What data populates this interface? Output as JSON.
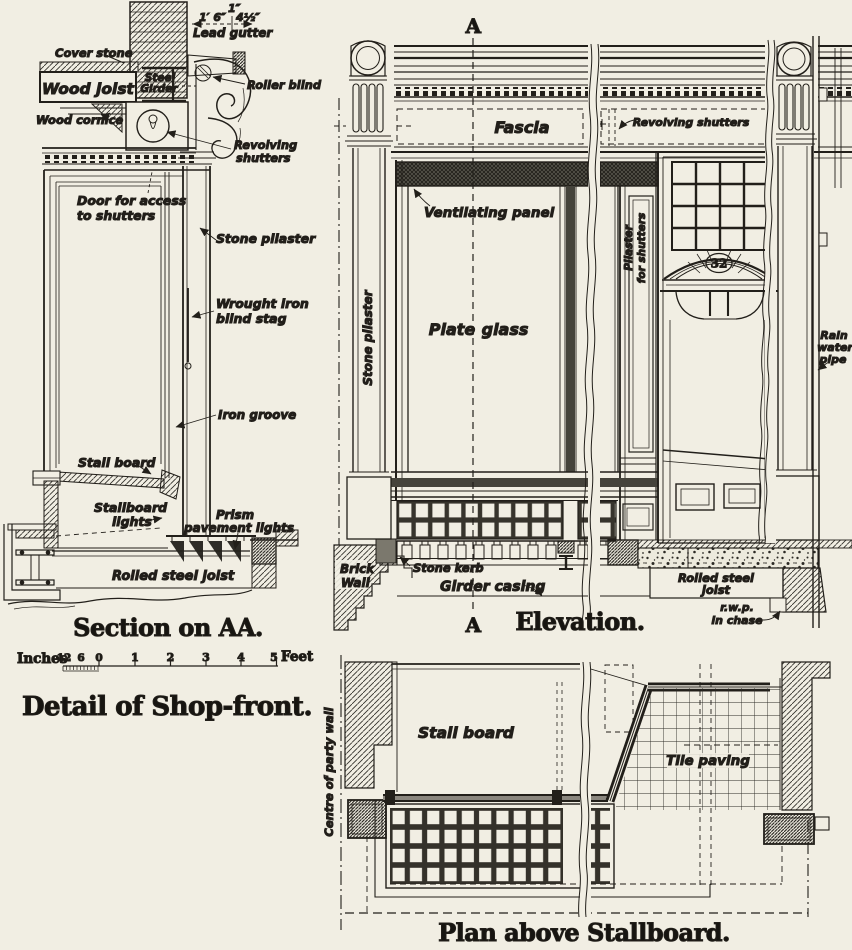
{
  "section": {
    "title": "Section on AA.",
    "dims": {
      "top": "1″",
      "gutter_width": "1′ 6″",
      "right": "4½″"
    },
    "labels": {
      "lead_gutter": "Lead gutter",
      "cover_stone": "Cover stone",
      "wood_joist": "Wood joist",
      "steel_1": "Steel",
      "steel_2": "Girder",
      "wood_cornice": "Wood cornice",
      "roller_blind": "Roller blind",
      "rev_1": "Revolving",
      "rev_2": "shutters",
      "door_1": "Door for access",
      "door_2": "to shutters",
      "stone_pilaster": "Stone pilaster",
      "stag_1": "Wrought iron",
      "stag_2": "blind stag",
      "iron_groove": "Iron groove",
      "stall_board": "Stall board",
      "sbl_1": "Stallboard",
      "sbl_2": "lights",
      "prism_1": "Prism",
      "prism_2": "pavement lights",
      "rsj": "Rolled steel joist"
    }
  },
  "scale_bar": {
    "inches_label": "Inches",
    "feet_label": "Feet",
    "inch_marks": [
      "12",
      "6",
      "0"
    ],
    "foot_marks": [
      "1",
      "2",
      "3",
      "4",
      "5"
    ]
  },
  "drawing_title": "Detail of Shop-front.",
  "elevation": {
    "title": "Elevation.",
    "marker_top": "A",
    "marker_bottom": "A",
    "labels": {
      "fascia": "Fascia",
      "revolving_shutters": "Revolving shutters",
      "ventilating_panel": "Ventilating panel",
      "stone_pilaster": "Stone pilaster",
      "plate_1": "Plate",
      "plate_2": "glass",
      "pfs_1": "Pilaster",
      "pfs_2": "for shutters",
      "door_number": "32",
      "rain_1": "Rain",
      "rain_2": "water",
      "rain_3": "pipe",
      "brick_1": "Brick",
      "brick_2": "Wall",
      "stone_kerb": "Stone kerb",
      "girder_casing": "Girder casing",
      "rsj_1": "Rolled steel",
      "rsj_2": "joist",
      "rwp_1": "r.w.p.",
      "rwp_2": "in chase"
    }
  },
  "plan": {
    "title": "Plan above Stallboard.",
    "labels": {
      "centre_party_wall": "Centre of party wall",
      "stall_board": "Stall board",
      "tile_paving": "Tile paving"
    }
  }
}
